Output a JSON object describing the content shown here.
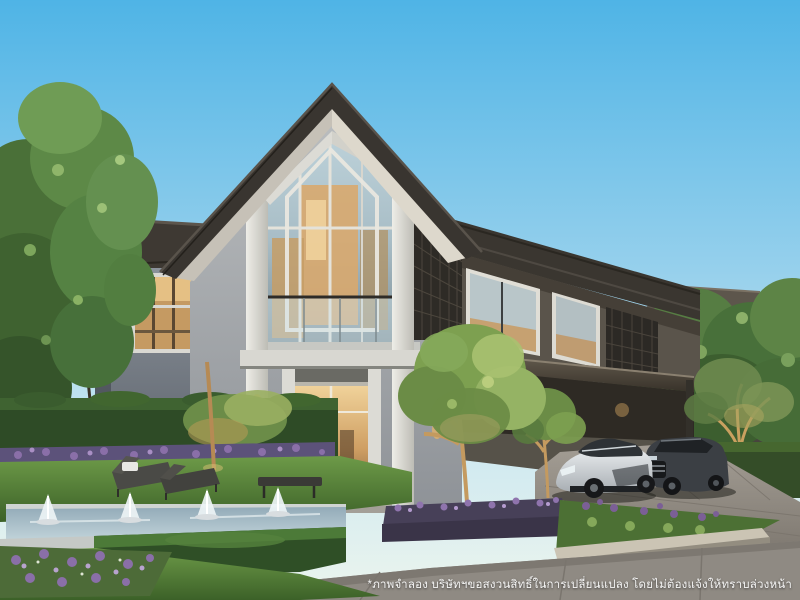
{
  "scene": {
    "type": "3d-architectural-rendering",
    "subject": "Modern two-storey detached house at dusk with a tall glass gable facade, warm interior lighting, landscaped garden, linear fountain pools, sun loungers, and two cars parked under the carport",
    "time_of_day": "dusk / early evening",
    "watermark": {
      "disclaimer": "*ภาพจำลอง บริษัทฯขอสงวนสิทธิ์ในการเปลี่ยนแปลง โดยไม่ต้องแจ้งให้ทราบล่วงหน้า"
    },
    "elements": [
      "main-house",
      "glass-gable-facade",
      "balcony-glass-railing",
      "lattice-screen",
      "left-wing-bay-window",
      "right-wing-carport",
      "background-house",
      "silver-sports-car",
      "dark-suv",
      "fountain-pool-with-jets",
      "sun-loungers",
      "hedge-wall",
      "purple-flower-beds",
      "lawn",
      "driveway",
      "walkway"
    ]
  },
  "colors": {
    "sky_top": "#55b7e7",
    "sky_horizon": "#e4f1ef",
    "roof_dark": "#3a362f",
    "wall_gray": "#828a93",
    "trim_white": "#e7e6e0",
    "window_warm": "#e0b376",
    "glass_cool": "#b3c9d3",
    "foliage_green": "#5d8549",
    "flower_purple": "#8a6fa8",
    "lawn_green": "#4f7d35",
    "pool_water": "#a9bfc9",
    "pavement": "#8f8a83",
    "car_silver": "#d9dde0",
    "car_dark": "#3b3f44",
    "text_white": "#ffffff"
  }
}
